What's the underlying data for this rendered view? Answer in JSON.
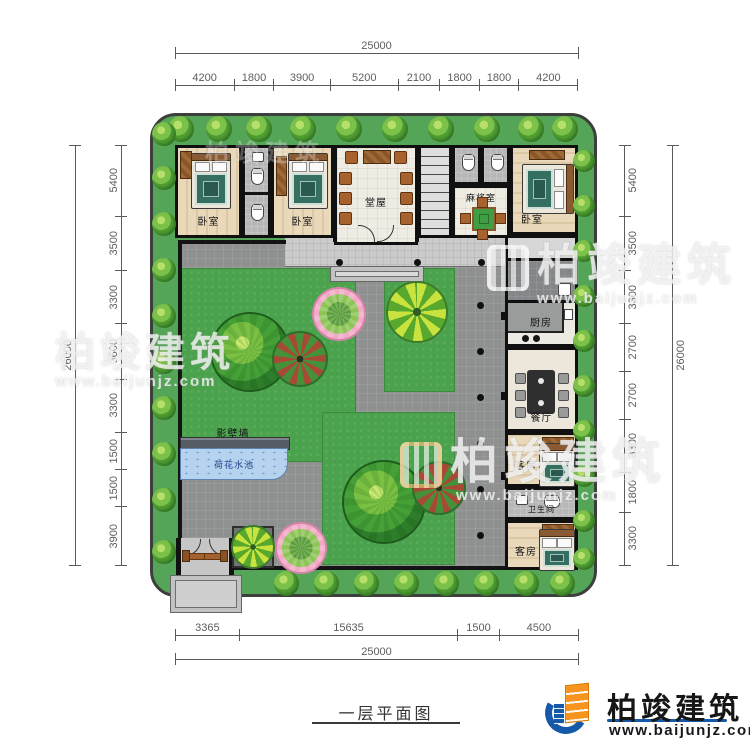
{
  "plan": {
    "title": "一层平面图",
    "rooms": {
      "bedroom1": "卧室",
      "bedroom2": "卧室",
      "bedroom3": "卧室",
      "hall": "堂屋",
      "mahjong": "麻将室",
      "kitchen": "厨房",
      "dining": "餐厅",
      "guest1": "客房",
      "guest2": "客房",
      "bathroom": "卫生间",
      "screen_wall": "影壁墙",
      "pool": "荷花水池"
    }
  },
  "dimensions": {
    "top": {
      "total": "25000",
      "segments": [
        "4200",
        "1800",
        "3900",
        "5200",
        "2100",
        "1800",
        "1800",
        "4200"
      ]
    },
    "bottom": {
      "total": "25000",
      "segments": [
        "3365",
        "15635",
        "1500",
        "4500"
      ]
    },
    "left": {
      "total": "26000",
      "segments": [
        "5400",
        "3500",
        "3300",
        "3600",
        "3300",
        "1500",
        "1500",
        "3900"
      ]
    },
    "right": {
      "total": "26000",
      "segments": [
        "5400",
        "3500",
        "3300",
        "2700",
        "2700",
        "3300",
        "1800",
        "3300"
      ]
    }
  },
  "branding": {
    "name": "柏竣建筑",
    "url": "www.baijunjz.com"
  },
  "colors": {
    "site_green": "#54a558",
    "lawn_green": "#4aa24c",
    "path_gray": "#8f9090",
    "pool_blue": "#b5d2ef",
    "wall_black": "#141414",
    "accent_blue": "#1659a8",
    "accent_orange": "#f7941d"
  }
}
